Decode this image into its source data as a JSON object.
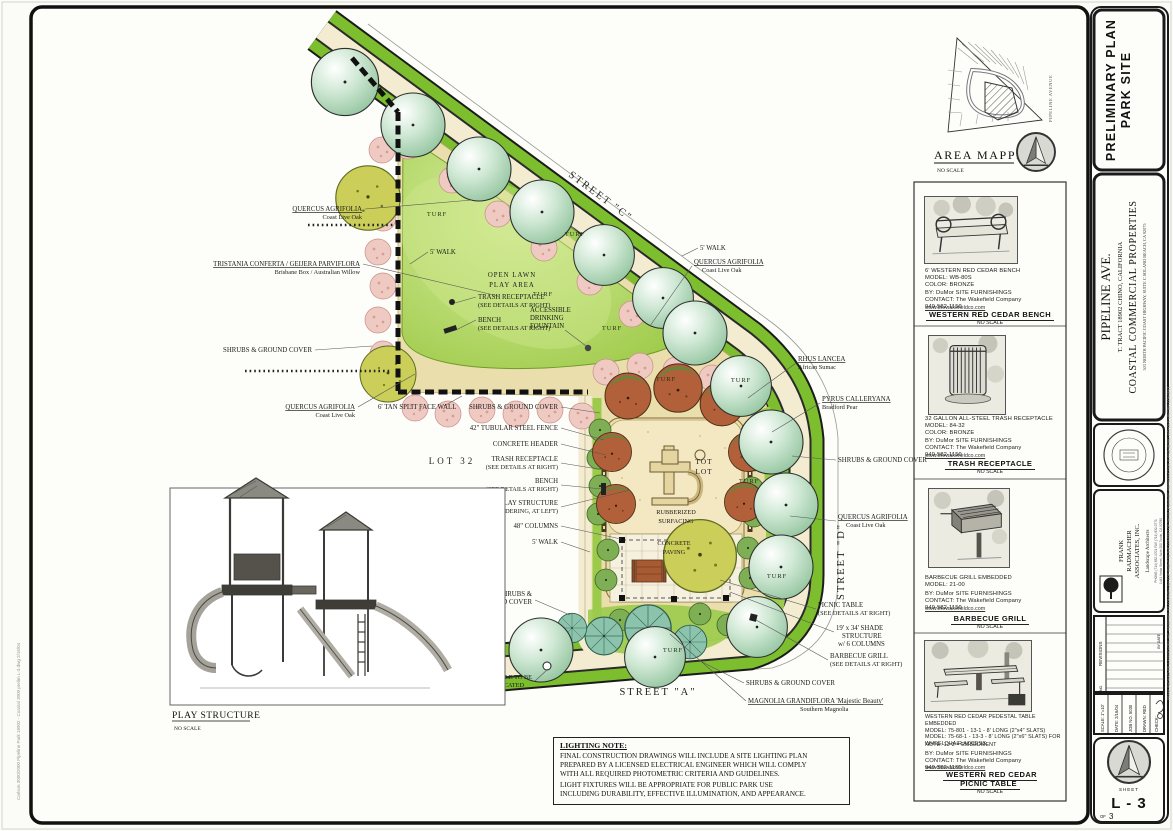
{
  "misc": {
    "no_scale": "NO SCALE"
  },
  "palette": {
    "parkway_green": "#7DBE2E",
    "lawn_green": "#A3D14D",
    "groundcover_tan": "#EADFAC",
    "sand": "#F4E8C2",
    "concrete": "#F6F1DF",
    "tree_mint": "#CFE8D4",
    "pink_shrub": "#EFCAC2",
    "rust_tree": "#B2603A",
    "frame_ink": "#1A1A1A"
  },
  "titleblock": {
    "banner_line1": "PRELIMINARY PLAN",
    "banner_line2": "PARK SITE",
    "project_name": "PIPELINE AVE.",
    "project_tract": "T. TRACT 18902     CHINO, CALIFORNIA",
    "client": "COASTAL COMMERCIAL PROPERTIES",
    "client_address": "503 NORTH PACIFIC COAST HIGHWAY, SUITE C      SOLANO BEACH, CA 92075",
    "firm_line1": "FRANK",
    "firm_line2": "RADMACHER",
    "firm_line3": "ASSOCIATES, INC.",
    "firm_type": "Landscape Architects",
    "firm_contact1": "PHONE (714) 832-1701   FAX (714) 832-0771",
    "firm_contact2": "1441 Yorba Street, Suite 200    Tustin, CA 92780",
    "revisions_label": "REVISIONS",
    "revisions_no": "NO.",
    "revisions_by_date": "BY  DATE",
    "scale": "SCALE:  1\"=10'",
    "date": "DATE:  2/16/04",
    "job": "JOB NO.  5030",
    "drawn": "DRAWN:  RED",
    "check": "CHECK:",
    "sheet_label": "SHEET",
    "sheet_no": "L - 3",
    "of_label": "OF",
    "of_value": "3",
    "copyright_note": "FRANK RADMACHER & ASSOCIATES, INC. RESERVES ITS COMMON LAW COPYRIGHT TO THE CONTENT OF THESE DRAWINGS. REPRODUCTION IS PROHIBITED WITHOUT WRITTEN CONSENT.",
    "plot_note": "Carlson 3000/2000 Pipeline Park 18902 - Coastal 3000 prelim L-3.dwg  2/16/04"
  },
  "area_mapped": {
    "title": "AREA MAPPED",
    "street": "PIPELINE AVENUE"
  },
  "details": {
    "vendor": "BY: DuMor SITE FURNISHINGS\nCONTACT: The Wakefield Company\n949-582-1150",
    "web": "www.thewakefieldco.com",
    "bench": {
      "desc": "6' WESTERN RED CEDAR BENCH\nMODEL: WB-80S\nCOLOR: BRONZE",
      "title": "WESTERN RED CEDAR BENCH"
    },
    "trash": {
      "desc": "32 GALLON ALL-STEEL TRASH RECEPTACLE\nMODEL: 84-32\nCOLOR: BRONZE",
      "title": "TRASH RECEPTACLE"
    },
    "grill": {
      "desc": "BARBECUE GRILL EMBEDDED\nMODEL: 21-00",
      "title": "BARBECUE GRILL"
    },
    "picnic": {
      "desc": "WESTERN RED CEDAR PEDESTAL TABLE EMBEDDED\nMODEL: 75-801 - 13-1 - 8' LONG (2\"x4\" SLATS)\nMODEL: 75-68-1 - 13-3 - 8' LONG (2\"x6\" SLATS) FOR WHEELCHAIR ACCESS",
      "note": "NOTE: 13-3 = EMBEDMENT",
      "title": "WESTERN RED CEDAR\nPICNIC TABLE"
    }
  },
  "plan": {
    "labels": {
      "oak": "QUERCUS AGRIFOLIA",
      "oak_sub": "Coast Live Oak",
      "tristania": "TRISTANIA CONFERTA / GEIJERA PARVIFLORA",
      "tristania_sub": "Brisbane Box / Australian Willow",
      "walk5": "5' WALK",
      "open_lawn1": "OPEN LAWN",
      "open_lawn2": "PLAY AREA",
      "turf": "TURF",
      "trash": "TRASH RECEPTACLE",
      "bench": "BENCH",
      "see_right": "(SEE DETAILS AT RIGHT)",
      "fountain1": "ACCESSIBLE",
      "fountain2": "DRINKING",
      "fountain3": "FOUNTAIN",
      "shrubs": "SHRUBS & GROUND COVER",
      "shrubs_a": "SHRUBS &",
      "shrubs_b": "GROUND COVER",
      "wall": "6' TAN SPLIT FACE WALL",
      "fence": "42\" TUBULAR STEEL FENCE",
      "header": "CONCRETE HEADER",
      "play1": "PLAY STRUCTURE",
      "play2": "(SEE RENDERING, AT LEFT)",
      "columns": "48\" COLUMNS",
      "rhus": "RHUS LANCEA",
      "rhus_sub": "African Sumac",
      "pyrus": "PYRUS CALLERYANA",
      "pyrus_sub": "Bradford Pear",
      "picnic": "PICNIC TABLE",
      "shade1": "19' x 34' SHADE",
      "shade2": "STRUCTURE",
      "shade3": "w/ 6 COLUMNS",
      "grill": "BARBECUE GRILL",
      "magnolia": "MAGNOLIA GRANDIFLORA 'Majestic Beauty'",
      "magnolia_sub": "Southern Magnolia",
      "manhole1": "MANHOLE TO BE",
      "manhole2": "RELOCATED",
      "tot1": "TOT",
      "tot2": "LOT",
      "rubber1": "RUBBERIZED",
      "rubber2": "SURFACING",
      "conc1": "CONCRETE",
      "conc2": "PAVING",
      "lot": "LOT  32",
      "street_c": "STREET \"C\"",
      "street_d": "STREET \"D\"",
      "street_a": "STREET \"A\""
    }
  },
  "play_structure": {
    "title": "PLAY STRUCTURE"
  },
  "lighting": {
    "title": "LIGHTING NOTE:",
    "p1": "FINAL CONSTRUCTION DRAWINGS WILL INCLUDE A SITE LIGHTING PLAN\nPREPARED BY A LICENSED ELECTRICAL ENGINEER WHICH WILL COMPLY\nWITH ALL REQUIRED PHOTOMETRIC CRITERIA AND GUIDELINES.",
    "p2": "LIGHT FIXTURES WILL BE APPROPRIATE FOR PUBLIC PARK USE\nINCLUDING DURABILITY, EFFECTIVE ILLUMINATION, AND APPEARANCE."
  }
}
